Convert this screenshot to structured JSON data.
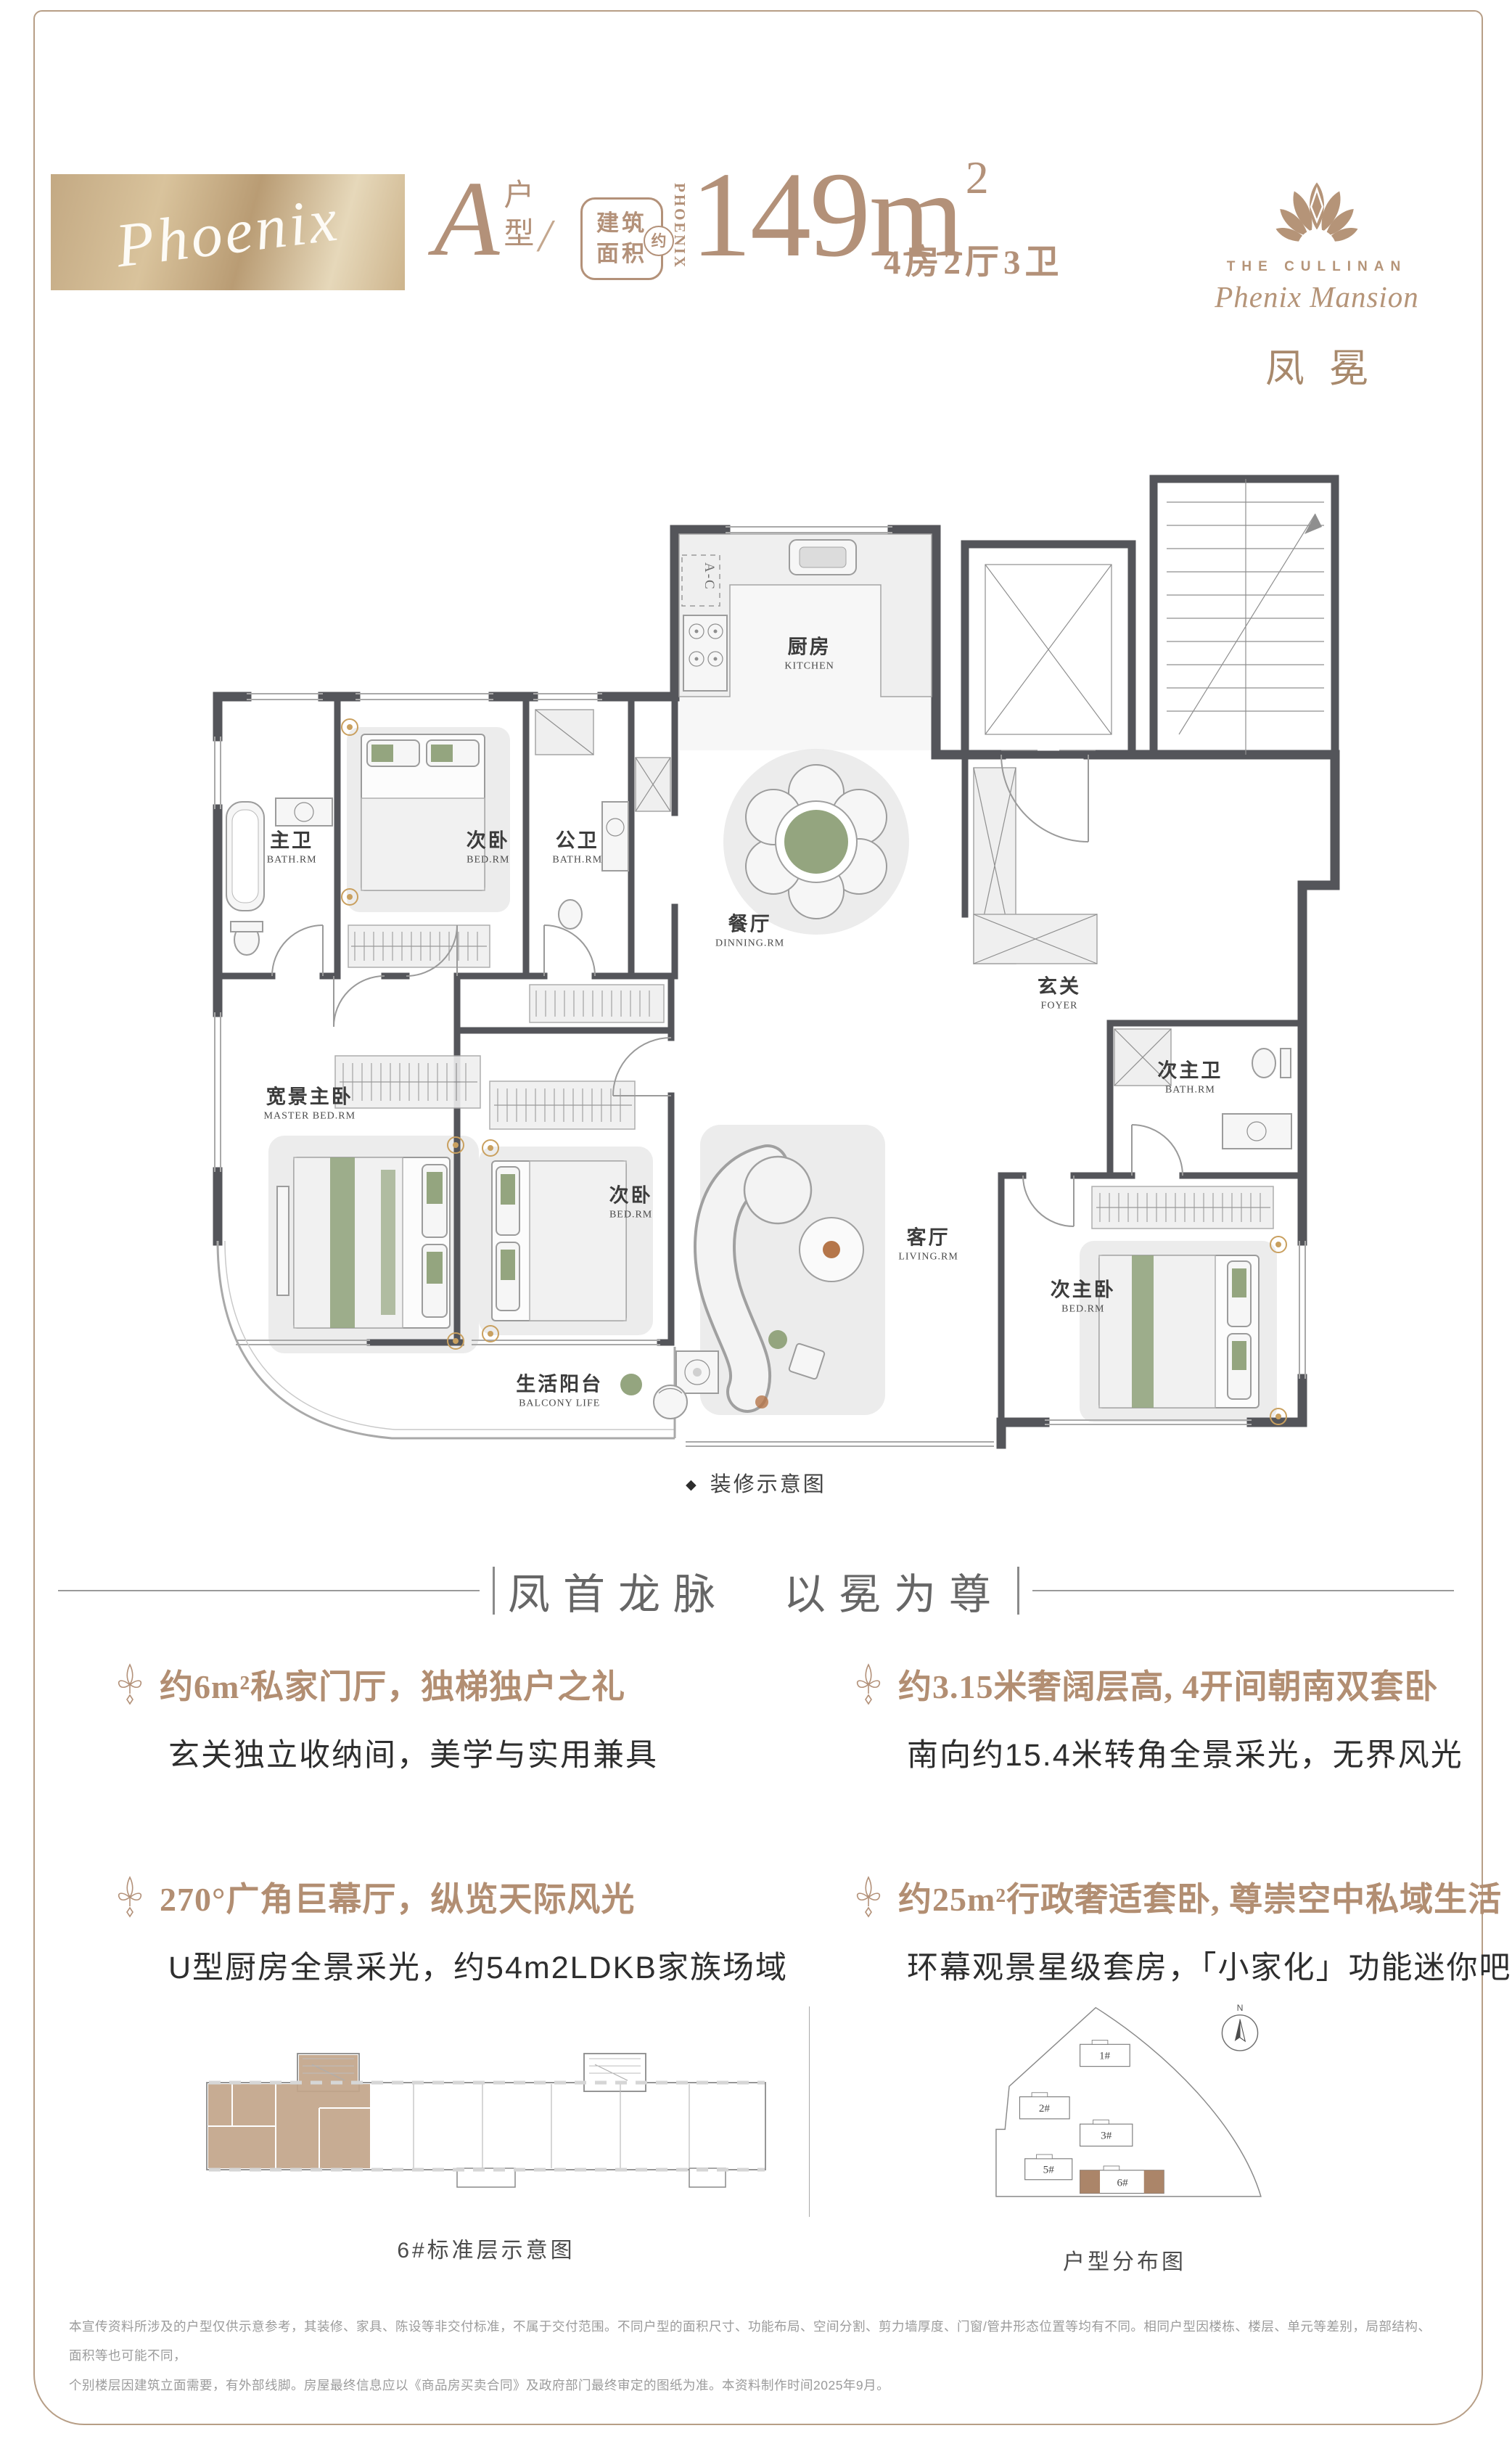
{
  "header": {
    "banner_script": "Phoenix",
    "unit": {
      "letter": "A",
      "type_label": "户型",
      "slash": "/"
    },
    "badge": {
      "line1": "建筑",
      "line2": "面积",
      "approx": "约"
    },
    "phoenix_vertical": "PHOENIX",
    "area": {
      "value": "149m",
      "sup": "2"
    },
    "rooms_summary": "4房2厅3卫",
    "brand": {
      "en_small": "THE CULLINAN",
      "en": "Phenix Mansion",
      "cn": "凤冕"
    }
  },
  "floorplan": {
    "caption": {
      "bullet": "◆",
      "text": "装修示意图"
    },
    "ac_label": "A-C",
    "rooms": [
      {
        "cn": "主卫",
        "en": "BATH.RM"
      },
      {
        "cn": "次卧",
        "en": "BED.RM"
      },
      {
        "cn": "公卫",
        "en": "BATH.RM"
      },
      {
        "cn": "厨房",
        "en": "KITCHEN"
      },
      {
        "cn": "餐厅",
        "en": "DINNING.RM"
      },
      {
        "cn": "玄关",
        "en": "FOYER"
      },
      {
        "cn": "次主卫",
        "en": "BATH.RM"
      },
      {
        "cn": "宽景主卧",
        "en": "MASTER BED.RM"
      },
      {
        "cn": "次卧",
        "en": "BED.RM"
      },
      {
        "cn": "客厅",
        "en": "LIVING.RM"
      },
      {
        "cn": "次主卧",
        "en": "BED.RM"
      },
      {
        "cn": "生活阳台",
        "en": "BALCONY LIFE"
      }
    ]
  },
  "section": {
    "heading": "凤首龙脉　以冕为尊"
  },
  "features": [
    {
      "title": "约6m²私家门厅，独梯独户之礼",
      "desc": "玄关独立收纳间，美学与实用兼具"
    },
    {
      "title": "约3.15米奢阔层高, 4开间朝南双套卧",
      "desc": "南向约15.4米转角全景采光，无界风光"
    },
    {
      "title": "270°广角巨幕厅，纵览天际风光",
      "desc": "U型厨房全景采光，约54m2LDKB家族场域"
    },
    {
      "title": "约25m²行政奢适套卧, 尊崇空中私域生活",
      "desc": "环幕观景星级套房，「小家化」功能迷你吧"
    }
  ],
  "diagrams": {
    "floor": {
      "caption": "6#标准层示意图"
    },
    "site": {
      "caption": "户型分布图",
      "compass": "N",
      "buildings": [
        "1#",
        "2#",
        "3#",
        "5#",
        "6#"
      ]
    }
  },
  "disclaimer": {
    "line1": "本宣传资料所涉及的户型仅供示意参考，其装修、家具、陈设等非交付标准，不属于交付范围。不同户型的面积尺寸、功能布局、空间分割、剪力墙厚度、门窗/管井形态位置等均有不同。相同户型因楼栋、楼层、单元等差别，局部结构、面积等也可能不同，",
    "line2": "个别楼层因建筑立面需要，有外部线脚。房屋最终信息应以《商品房买卖合同》及政府部门最终审定的图纸为准。本资料制作时间2025年9月。"
  }
}
